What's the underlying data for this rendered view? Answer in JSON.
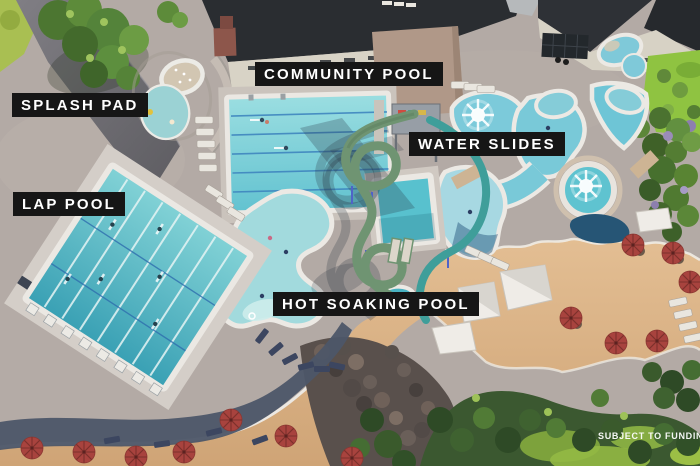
{
  "labels": {
    "splash_pad": "SPLASH PAD",
    "community_pool": "COMMUNITY POOL",
    "water_slides": "WATER SLIDES",
    "lap_pool": "LAP POOL",
    "hot_soaking_pool": "HOT SOAKING POOL"
  },
  "footnote": "SUBJECT TO FUNDING",
  "palette": {
    "label_background": "#161616",
    "label_text": "#ffffff",
    "concrete_deck": "#b3aaa5",
    "pool_water": "#5ac1ce",
    "lap_pool_water": "#45aebf",
    "lagoon_water": "#a2dadd",
    "slide_green": "#6f9472",
    "slide_teal": "#3f9e9a",
    "wood_deck": "#dcb384",
    "sand": "#d8ac7a",
    "umbrella_red": "#a8433e",
    "roof_dark": "#2b2e32",
    "building_cream": "#d8d3c6",
    "grass_green": "#8fc341",
    "forest_green": "#3f5c31",
    "shadow_blue": "#4d5668"
  }
}
